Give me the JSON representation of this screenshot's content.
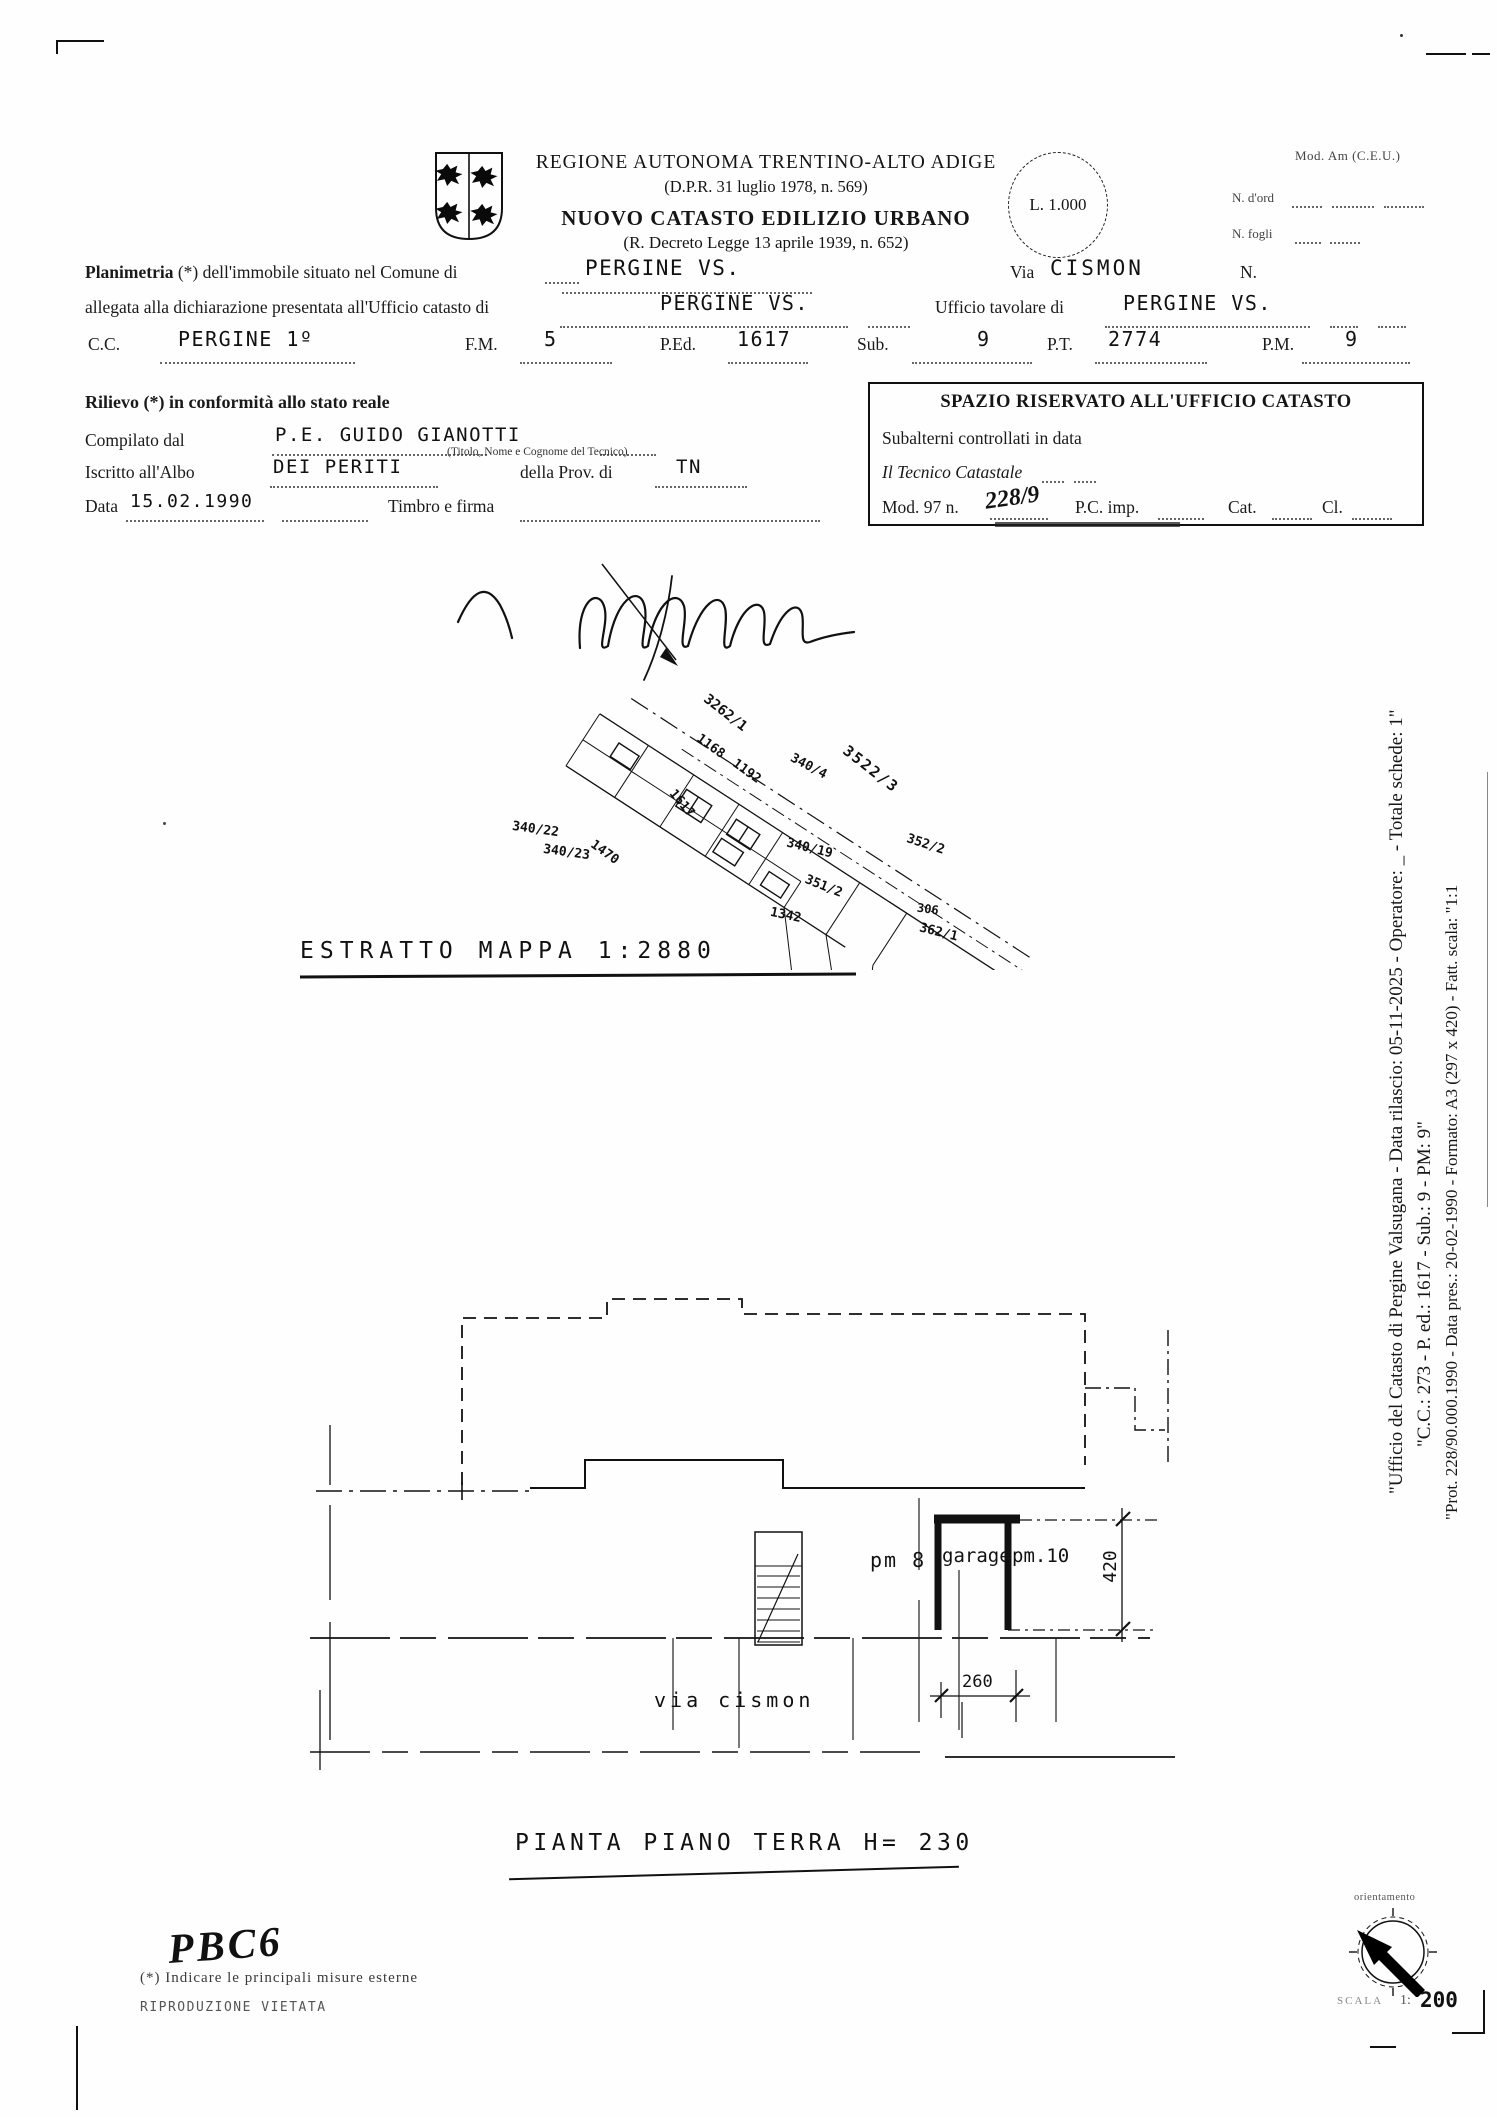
{
  "header": {
    "region_title": "REGIONE AUTONOMA TRENTINO-ALTO ADIGE",
    "region_subtitle": "(D.P.R. 31 luglio 1978, n. 569)",
    "catasto_title": "NUOVO CATASTO EDILIZIO URBANO",
    "catasto_subtitle": "(R. Decreto Legge 13 aprile 1939, n. 652)",
    "stamp_value": "L. 1.000",
    "mod_label": "Mod. Am (C.E.U.)",
    "n_ord_label": "N. d'ord",
    "n_fogli_label": "N. fogli"
  },
  "form": {
    "row1_bold": "Planimetria",
    "row1_rest": " (*) dell'immobile situato nel Comune di",
    "comune_value": "PERGINE VS.",
    "via_label": "Via",
    "via_value": "CISMON",
    "n_label": "N.",
    "row2_label": "allegata alla dichiarazione presentata all'Ufficio catasto di",
    "catasto_di_value": "PERGINE VS.",
    "tavolare_label": "Ufficio tavolare di",
    "tavolare_value": "PERGINE VS.",
    "cc_label": "C.C.",
    "cc_value": "PERGINE 1º",
    "fm_label": "F.M.",
    "fm_value": "5",
    "ped_label": "P.Ed.",
    "ped_value": "1617",
    "sub_label": "Sub.",
    "sub_value": "9",
    "pt_label": "P.T.",
    "pt_value": "2774",
    "pm_label": "P.M.",
    "pm_value": "9"
  },
  "rilievo": {
    "title": "Rilievo (*) in conformità allo stato reale",
    "compilato_label": "Compilato dal",
    "compilato_value": "P.E. GUIDO GIANOTTI",
    "tecnico_caption": "(Titolo, Nome e Cognome del Tecnico)",
    "albo_label": "Iscritto all'Albo",
    "albo_value": "DEI PERITI",
    "prov_label": "della Prov. di",
    "prov_value": "TN",
    "data_label": "Data",
    "data_value": "15.02.1990",
    "timbro_label": "Timbro e firma"
  },
  "ufficio_box": {
    "title": "SPAZIO RISERVATO ALL'UFFICIO CATASTO",
    "subalterni_label": "Subalterni controllati in data",
    "tecnico_label": "Il Tecnico Catastale",
    "mod97_label": "Mod. 97 n.",
    "mod97_value": "228/9",
    "pc_label": "P.C. imp.",
    "cat_label": "Cat.",
    "cl_label": "Cl."
  },
  "map": {
    "title": "ESTRATTO MAPPA 1:2880",
    "parcels": [
      "3262/1",
      "1168",
      "1192",
      "340/4",
      "3522/3",
      "340/22",
      "1617",
      "340/23",
      "1470",
      "340/19",
      "351/2",
      "352/2",
      "1342",
      "306",
      "362/1"
    ]
  },
  "plan": {
    "pm8": "pm 8",
    "garage": "garage",
    "pm10": "pm.10",
    "dim_height": "420",
    "dim_width": "260",
    "street": "via cismon",
    "title": "PIANTA PIANO TERRA H= 230"
  },
  "footer": {
    "handwritten": "PBC6",
    "note": "(*) Indicare le principali misure esterne",
    "riproduzione": "RIPRODUZIONE VIETATA",
    "orientamento": "orientamento",
    "scala_label": "SCALA",
    "scala_sep": "1:",
    "scala_value": "200"
  },
  "sidebar": {
    "line1": "\"Ufficio del Catasto di Pergine Valsugana - Data rilascio: 05-11-2025 - Operatore: _ - Totale schede: 1\"",
    "line2": "\"C.C.: 273 - P. ed.: 1617 - Sub.: 9 - PM: 9\"",
    "line3": "\"Prot. 228/90.000.1990 - Data pres.: 20-02-1990 - Formato: A3 (297 x 420) - Fatt. scala: \"1:1"
  }
}
